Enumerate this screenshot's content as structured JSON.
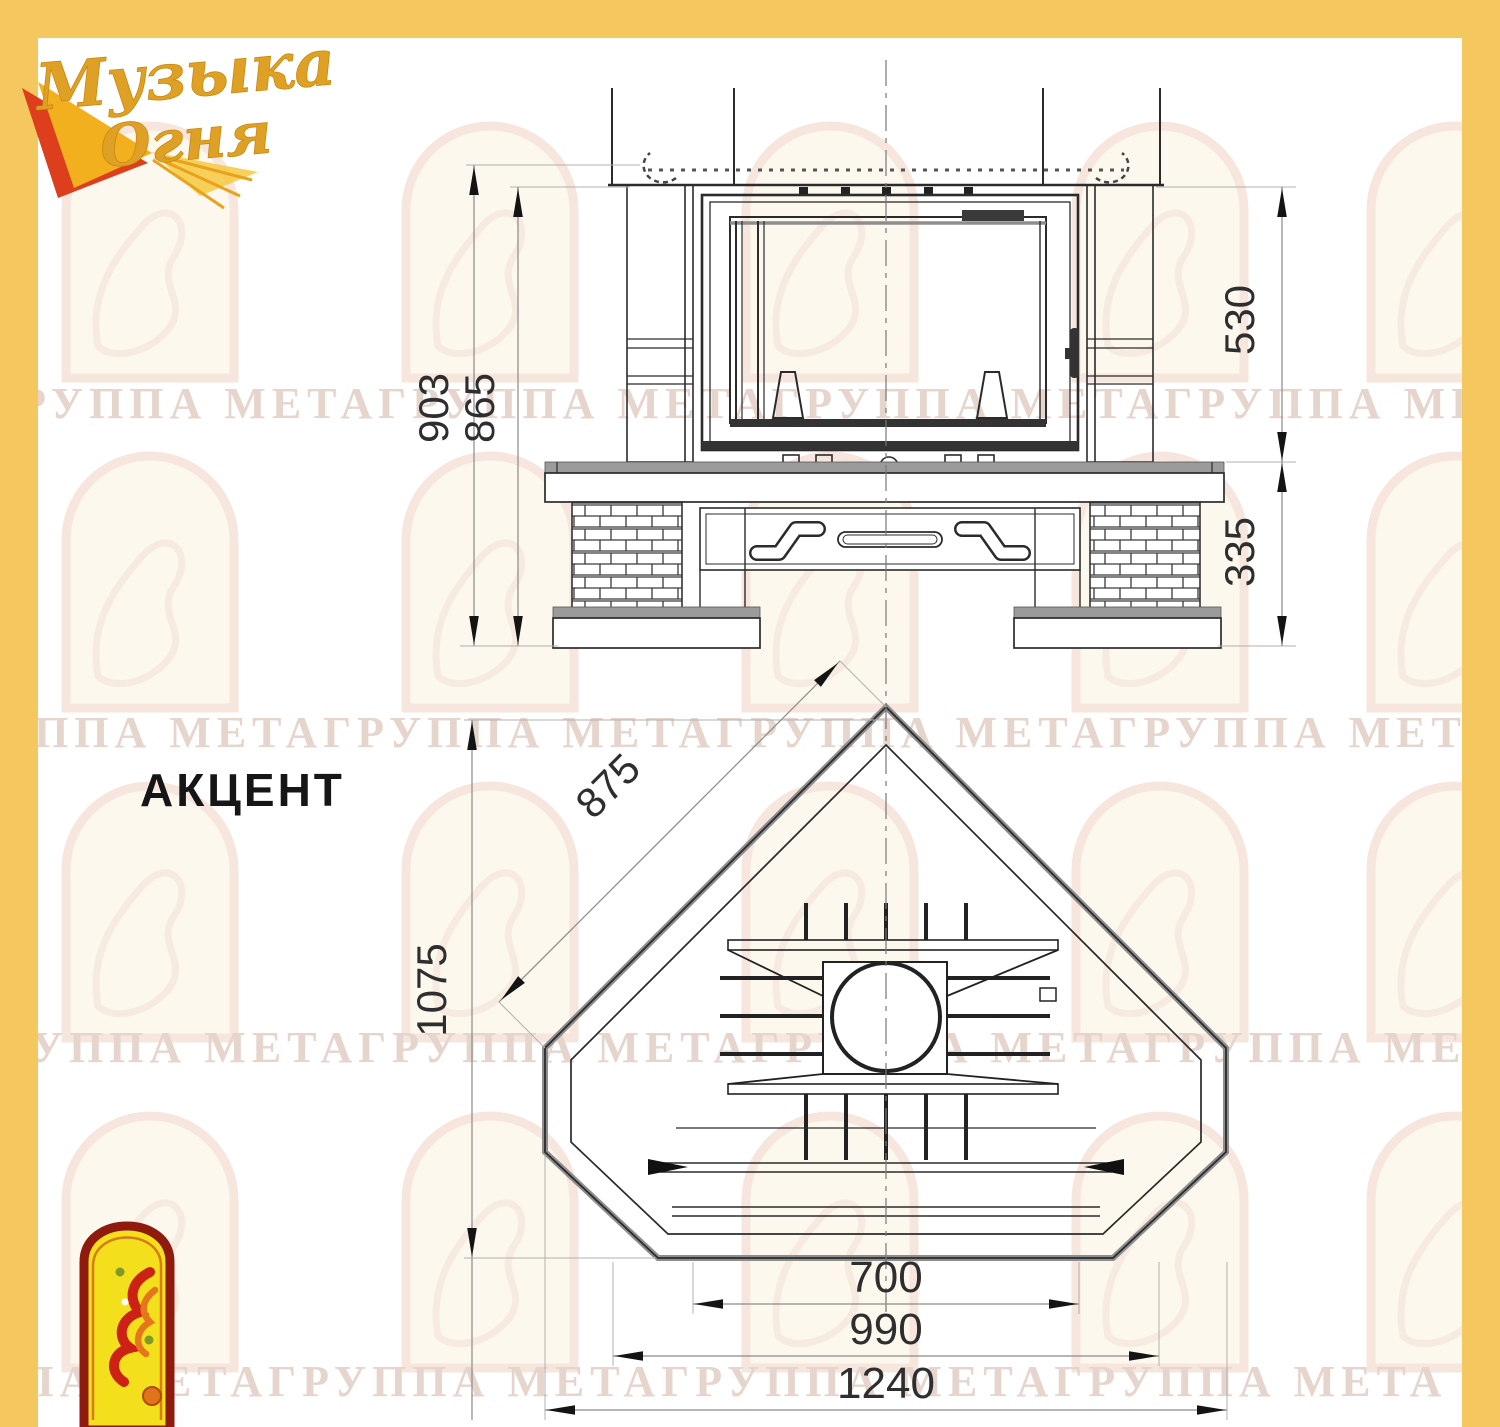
{
  "colors": {
    "frame_yellow": "#F5C75F",
    "line_dark": "#2b2b2b",
    "slab_gray": "#9b9b9b",
    "dim_line": "#8a8a8a",
    "watermark_text": "#E6D5CD",
    "label_dark": "#161616",
    "logo_gold": "#DFA125",
    "logo_red": "#DD3E1B",
    "emblem_border_red": "#8E1B0E",
    "emblem_yellow": "#F4DF1C"
  },
  "logo": {
    "word1": "Музыка",
    "word2": "Огня"
  },
  "model_label": "АКЦЕНТ",
  "watermark": {
    "row_text": "ГРУППА МЕТАГРУППА МЕТАГРУППА МЕТАГРУППА МЕТА"
  },
  "front_view": {
    "dim_overall_height": "903",
    "dim_mantel_height": "865",
    "dim_upper_zone": "530",
    "dim_base_height": "335"
  },
  "plan_view": {
    "dim_side_edge": "875",
    "dim_depth": "1075",
    "dim_inner_width": "700",
    "dim_mid_width": "990",
    "dim_overall_width": "1240"
  }
}
